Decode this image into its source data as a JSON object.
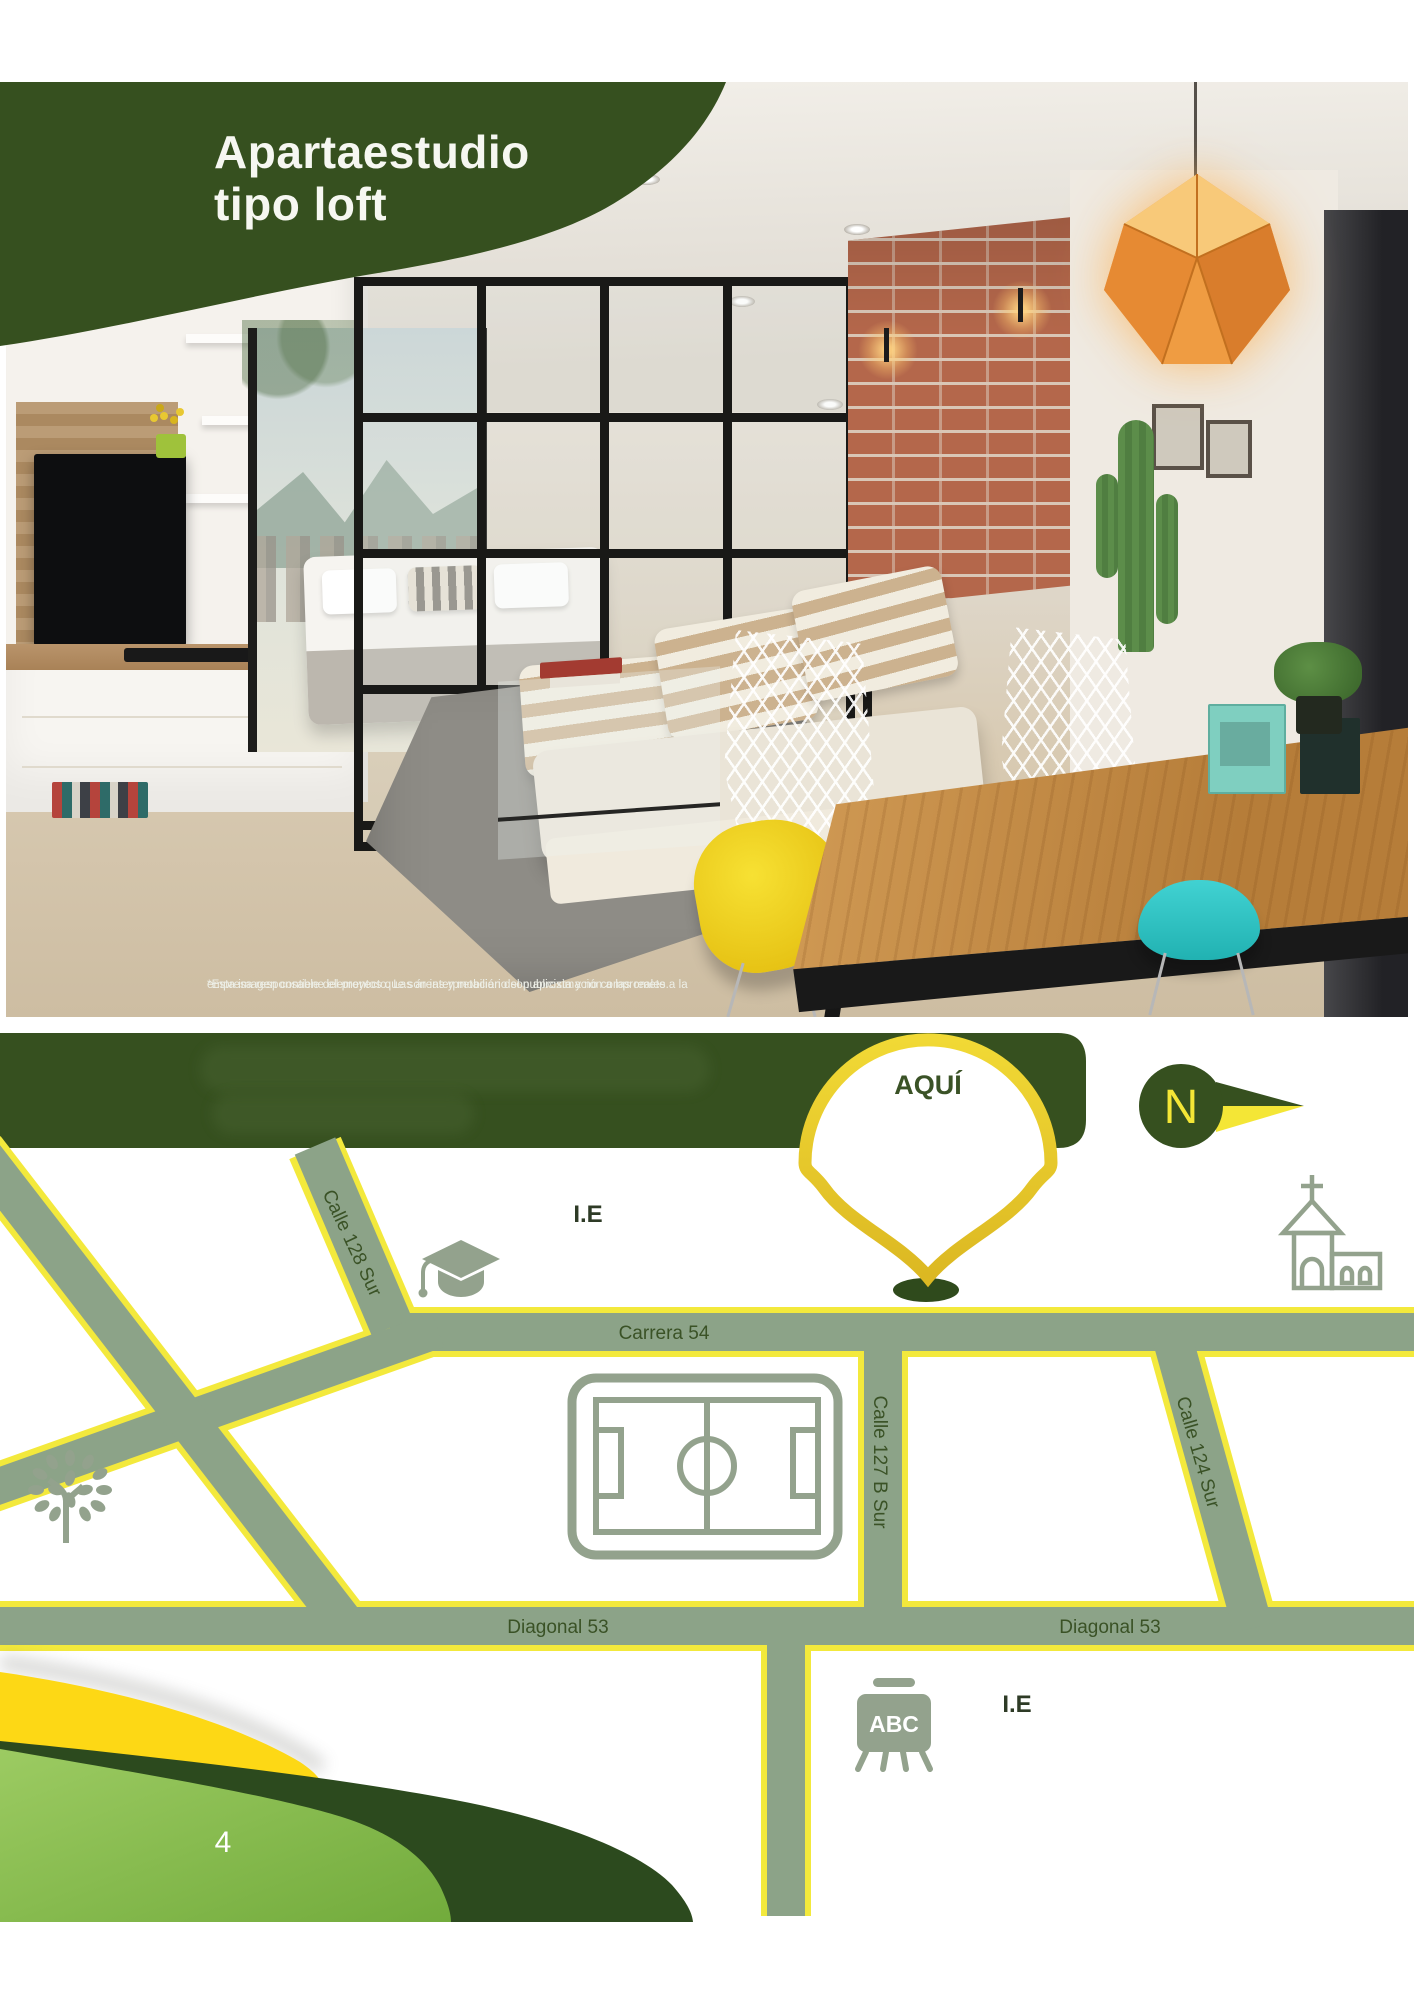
{
  "page": {
    "number": "4"
  },
  "hero": {
    "title_line1": "Apartaestudio",
    "title_line2": "tipo loft",
    "disclaimer_line1": "*Esta imagen contiene elementos que son interpretación del publicista y no compromete a la",
    "disclaimer_line2": "empresa responsable del proyecto. Las áreas y mobiliario son aproximación a las reales."
  },
  "map": {
    "marker_label": "AQUÍ",
    "compass_letter": "N",
    "roads": {
      "carrera_54": "Carrera 54",
      "calle_128_sur": "Calle 128 Sur",
      "calle_127b_sur": "Calle 127 B Sur",
      "calle_124_sur": "Calle 124 Sur",
      "diagonal_53_left": "Diagonal 53",
      "diagonal_53_right": "Diagonal 53"
    },
    "pois": {
      "school_top": "I.E",
      "school_bottom": "I.E",
      "abc_board": "ABC"
    }
  },
  "colors": {
    "brand_green": "#364c22",
    "road_fill": "#8ca388",
    "road_casing": "#f3e93c",
    "label_green": "#3a5226",
    "icon_sage": "#93a28d",
    "marker_ring": "#e9cc2e",
    "compass_yellow": "#f4e636",
    "wedge_yellow": "#fdd815",
    "wedge_dark": "#2c4a1e",
    "wedge_light": "#85bb4f"
  }
}
